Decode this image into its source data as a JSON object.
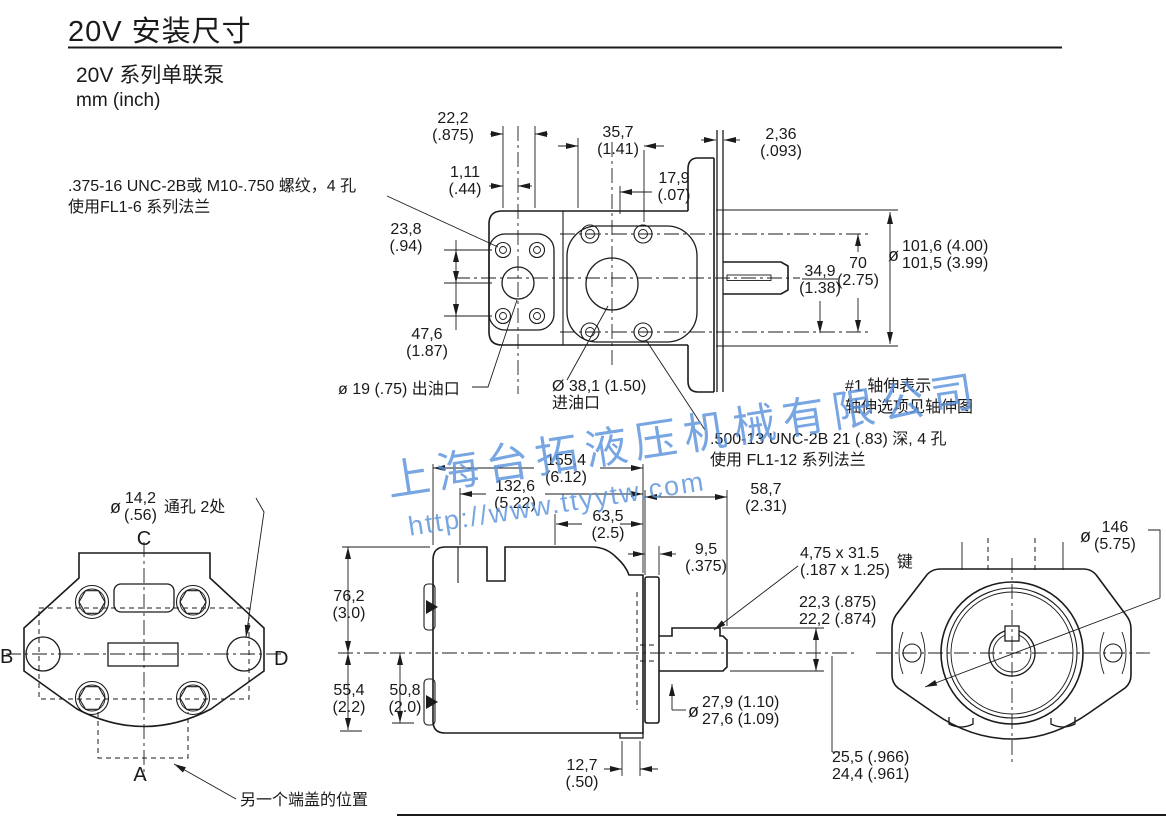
{
  "page": {
    "title": "20V 安装尺寸",
    "subtitle": "20V 系列单联泵",
    "units": "mm  (inch)"
  },
  "watermark": {
    "company": "上海台拓液压机械有限公司",
    "url": "http://www.ttyytw.com",
    "color": "#5a93dd"
  },
  "notes": {
    "top_thread": {
      "l1": ".375-16 UNC-2B或 M10-.750  螺纹，4  孔",
      "l2": "使用FL1-6 系列法兰"
    },
    "shaft": {
      "l1": "#1 轴伸表示",
      "l2": "轴伸选项见轴伸图"
    },
    "bottom_thread": {
      "l1": ".500-13 UNC-2B 21 (.83)   深, 4  孔",
      "l2": "使用  FL1-12 系列法兰"
    },
    "alt_cover": "另一个端盖的位置"
  },
  "view_labels": {
    "a": "A",
    "b": "B",
    "c": "C",
    "d": "D"
  },
  "dims": {
    "w22_2": {
      "l1": "22,2",
      "l2": "(.875)"
    },
    "w1_11": {
      "l1": "1,11",
      "l2": "(.44)"
    },
    "w35_7": {
      "l1": "35,7",
      "l2": "(1.41)"
    },
    "w17_9": {
      "l1": "17,9",
      "l2": "(.07)"
    },
    "w2_36": {
      "l1": "2,36",
      "l2": "(.093)"
    },
    "w23_8": {
      "l1": "23,8",
      "l2": "(.94)"
    },
    "w47_6": {
      "l1": "47,6",
      "l2": "(1.87)"
    },
    "w70": {
      "l1": "70",
      "l2": "(2.75)"
    },
    "w34_9": {
      "l1": "34,9",
      "l2": "(1.38)"
    },
    "w101": {
      "phi": "ø",
      "l1": "101,6 (4.00)",
      "l2": "101,5 (3.99)"
    },
    "outlet": {
      "text": "ø 19 (.75) 出油口"
    },
    "inlet": {
      "l1": "Ø 38,1 (1.50)",
      "l2": "进油口"
    },
    "w14_2": {
      "phi": "ø",
      "l1": "14,2",
      "l2": "(.56)",
      "suffix": "通孔 2处"
    },
    "w155_4": {
      "l1": "155,4",
      "l2": "(6.12)"
    },
    "w132_6": {
      "l1": "132,6",
      "l2": "(5.22)"
    },
    "w63_5": {
      "l1": "63,5",
      "l2": "(2.5)"
    },
    "w9_5": {
      "l1": "9,5",
      "l2": "(.375)"
    },
    "w58_7": {
      "l1": "58,7",
      "l2": "(2.31)"
    },
    "w76_2": {
      "l1": "76,2",
      "l2": "(3.0)"
    },
    "w55_4": {
      "l1": "55,4",
      "l2": "(2.2)"
    },
    "w50_8": {
      "l1": "50,8",
      "l2": "(2.0)"
    },
    "w12_7": {
      "l1": "12,7",
      "l2": "(.50)"
    },
    "w27_9": {
      "phi": "ø",
      "l1": "27,9 (1.10)",
      "l2": "27,6 (1.09)"
    },
    "key": {
      "l1": "4,75 x 31.5",
      "l2": "(.187 x 1.25)",
      "suffix": "键"
    },
    "w22_3": {
      "l1": "22,3 (.875)",
      "l2": "22,2 (.874)"
    },
    "w25_5": {
      "l1": "25,5 (.966)",
      "l2": "24,4 (.961)"
    },
    "w146": {
      "phi": "ø",
      "l1": "146",
      "l2": "(5.75)"
    }
  }
}
